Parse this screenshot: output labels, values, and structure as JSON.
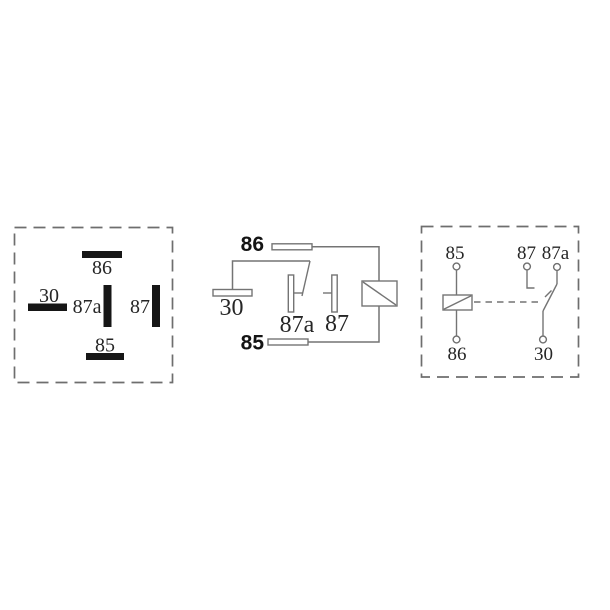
{
  "colors": {
    "background": "#ffffff",
    "dashed_border": "#6e6e6e",
    "line": "#747474",
    "pin_fill": "#161616",
    "label_text": "#262626",
    "bold_label_text": "#141414"
  },
  "pin_view": {
    "labels": {
      "p86": "86",
      "p30": "30",
      "p87a": "87a",
      "p87": "87",
      "p85": "85"
    }
  },
  "schematic": {
    "labels": {
      "t86": "86",
      "t30": "30",
      "t87a": "87a",
      "t87": "87",
      "t85": "85"
    }
  },
  "circuit_view": {
    "labels": {
      "t85": "85",
      "t87": "87",
      "t87a": "87a",
      "t86": "86",
      "t30": "30"
    }
  }
}
